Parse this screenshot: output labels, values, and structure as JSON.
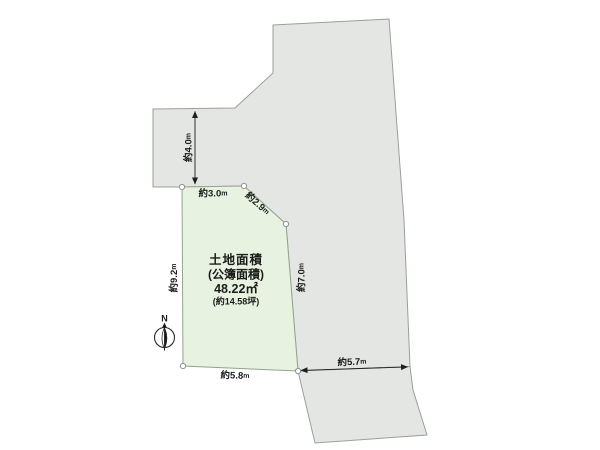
{
  "diagram": {
    "type": "land-plot-survey",
    "north_label": "N",
    "parcel": {
      "title_line1": "土地面積",
      "title_line2": "(公簿面積)",
      "area_value": "48.22㎡",
      "area_tsubo": "(約14.58坪)"
    },
    "dimensions": {
      "road_width": {
        "value": "約4.0",
        "unit": "m"
      },
      "top_edge": {
        "value": "約3.0",
        "unit": "m"
      },
      "corner_edge": {
        "value": "約2.9",
        "unit": "m"
      },
      "left_edge": {
        "value": "約9.2",
        "unit": "m"
      },
      "right_edge": {
        "value": "約7.0",
        "unit": "m"
      },
      "bottom_edge": {
        "value": "約5.8",
        "unit": "m"
      },
      "south_road": {
        "value": "約5.7",
        "unit": "m"
      }
    },
    "colors": {
      "background": "#ffffff",
      "parcel_fill": "#e7f3e0",
      "parcel_stroke": "#94a38e",
      "neighbor_fill": "#e4e6e3",
      "neighbor_stroke": "#9b9f9b",
      "dimension_color": "#1f1f1f",
      "vertex_fill": "#ffffff",
      "vertex_stroke": "#8f938f"
    }
  }
}
